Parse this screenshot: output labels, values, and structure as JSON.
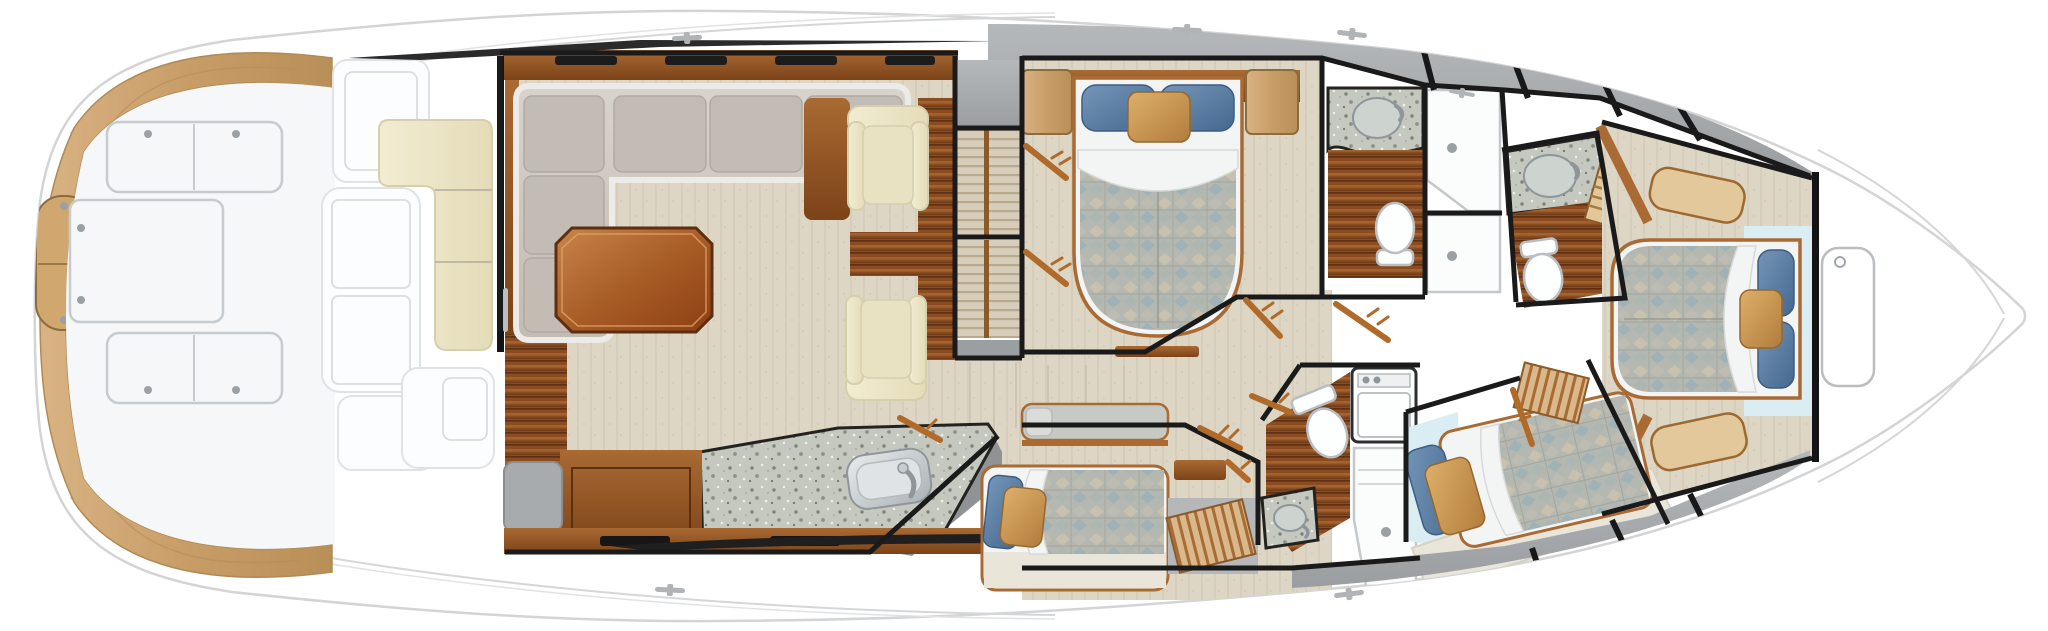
{
  "figure": {
    "kind": "yacht-interior-floor-plan",
    "orientation": {
      "stern": "left",
      "bow": "right"
    },
    "areas": [
      {
        "name": "swim-platform",
        "features": [
          "teak-deck",
          "transom-fishbox"
        ]
      },
      {
        "name": "cockpit",
        "features": [
          "deck-hatch",
          "deck-hatch-center",
          "deck-hatch-aft",
          "mezzanine-seat",
          "engine-room-access"
        ]
      },
      {
        "name": "salon",
        "features": [
          "sliding-door",
          "l-shaped-sofa",
          "coffee-table",
          "armchair",
          "armchair",
          "side-cabinet",
          "wood-floor",
          "carpet"
        ]
      },
      {
        "name": "galley",
        "features": [
          "granite-counter",
          "sink",
          "faucet",
          "cabinets",
          "drawer-bank"
        ]
      },
      {
        "name": "companionway",
        "features": [
          "stair-flight-upper",
          "stair-flight-lower",
          "handrail"
        ]
      },
      {
        "name": "master-stateroom",
        "features": [
          "queen-bed",
          "pillows",
          "nightstand",
          "nightstand",
          "headboard-cabinet",
          "closet-doors"
        ]
      },
      {
        "name": "master-head",
        "features": [
          "vanity-sink",
          "toilet",
          "shower",
          "teak-sole"
        ]
      },
      {
        "name": "day-head",
        "features": [
          "vanity-sink",
          "toilet",
          "shower",
          "teak-sole"
        ]
      },
      {
        "name": "guest-cabin-aft",
        "features": [
          "double-berth",
          "upper-berth",
          "step-box",
          "pillows"
        ]
      },
      {
        "name": "guest-cabin-mid",
        "features": [
          "angled-berth",
          "step-box",
          "pillows"
        ]
      },
      {
        "name": "lower-head",
        "features": [
          "toilet",
          "vanity-sink",
          "shower",
          "washer-dryer"
        ]
      },
      {
        "name": "vip-stateroom",
        "features": [
          "island-bed",
          "pillows",
          "step-bench-port",
          "step-bench-starboard"
        ]
      },
      {
        "name": "foredeck",
        "features": [
          "anchor-hatch",
          "deck-cleat"
        ]
      }
    ]
  },
  "palette": {
    "hullStroke": "#d2d4d6",
    "soleWhite": "#f5f7f8",
    "hatchStroke": "#c6cbcf",
    "teak": "#c89d67",
    "teakLight": "#d9b384",
    "teakDark": "#b98f58",
    "wood": "#8a4c20",
    "woodMid": "#a96a33",
    "woodDark": "#5d2e12",
    "woodLight": "#c88a4a",
    "cream": "#eee8ca",
    "creamStroke": "#d6cfae",
    "sofa": "#cfc9c2",
    "sofaCushion": "#c3bcb4",
    "sofaTrim": "#eceae6",
    "carpet": "#ddd6c4",
    "carpetStreak": "#cec6b2",
    "graySole": "#9b9fa2",
    "grayLight": "#b8bcbe",
    "wall": "#1a1a1a",
    "granite": "#c4c8bf",
    "graniteDot": "#7e8379",
    "graniteLight": "#eef1e9",
    "duvetBase": "#b4b8b1",
    "duvetTan": "#c9c2ae",
    "duvetBlue": "#9fb2b6",
    "duvetLine": "#8e9188",
    "pillowBlue": "#5e82a8",
    "pillowGold": "#cf9e55",
    "sheetWhite": "#f3f5f5",
    "paleBlue": "#d9edf3",
    "fixtureWhite": "#fdfefe",
    "fixtureStroke": "#b9bec2",
    "doorOrange": "#b06a2a",
    "stairCarpet": "#d6cdba",
    "tread": "#b9a98e",
    "bedBase": "#e9e5d9"
  }
}
